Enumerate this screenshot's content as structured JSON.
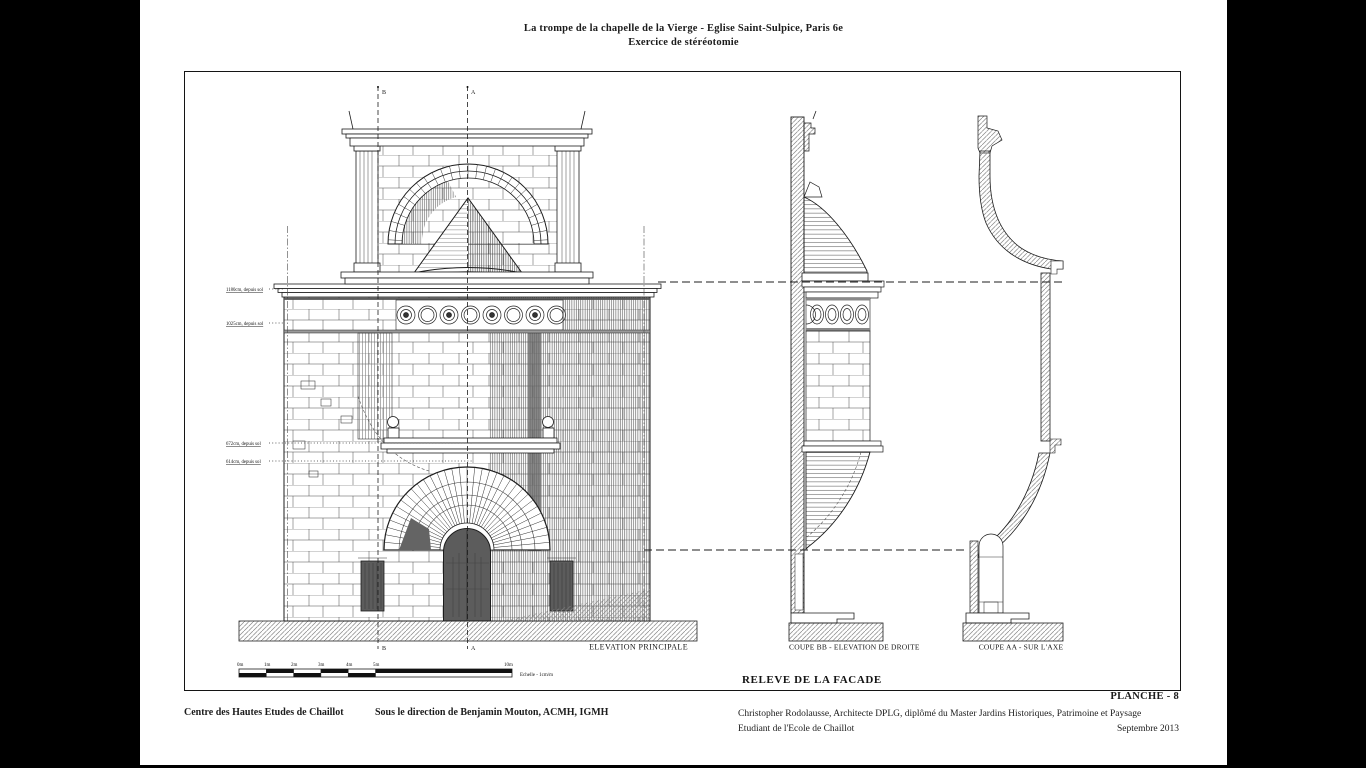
{
  "header": {
    "title_line1": "La trompe de la chapelle de la Vierge - Eglise Saint-Sulpice, Paris 6e",
    "title_line2": "Exercice de stéréotomie"
  },
  "plate": {
    "number_label": "PLANCHE - 8",
    "drawing_set_title": "RELEVE DE LA FACADE"
  },
  "views": {
    "elevation": {
      "caption": "ELEVATION PRINCIPALE",
      "axis_top_b": "B",
      "axis_top_a": "A",
      "axis_bottom_b": "B",
      "axis_bottom_a": "A"
    },
    "coupe_bb": {
      "caption": "COUPE BB - ELEVATION DE DROITE"
    },
    "coupe_aa": {
      "caption": "COUPE AA - SUR L'AXE"
    }
  },
  "level_annotations": [
    {
      "label": "1180cm, depuis sol"
    },
    {
      "label": "1025cm, depuis sol"
    },
    {
      "label": "672cm, depuis sol"
    },
    {
      "label": "614cm, depuis sol"
    }
  ],
  "scale_bar": {
    "ticks": [
      "0m",
      "1m",
      "2m",
      "3m",
      "4m",
      "5m",
      "10m"
    ],
    "caption": "Echelle - 1cm/m"
  },
  "footer": {
    "institution": "Centre des Hautes Etudes de Chaillot",
    "direction": "Sous le direction de Benjamin Mouton, ACMH, IGMH",
    "author_line1": "Christopher Rodolausse, Architecte DPLG, diplômé du Master Jardins Historiques, Patrimoine et Paysage",
    "author_line2": "Etudiant de l'Ecole de Chaillot",
    "date": "Septembre 2013"
  },
  "colors": {
    "background": "#000000",
    "paper": "#ffffff",
    "ink": "#1c1c1c",
    "hatch_gray": "#868686",
    "dark_fill": "#5c5c5c"
  }
}
